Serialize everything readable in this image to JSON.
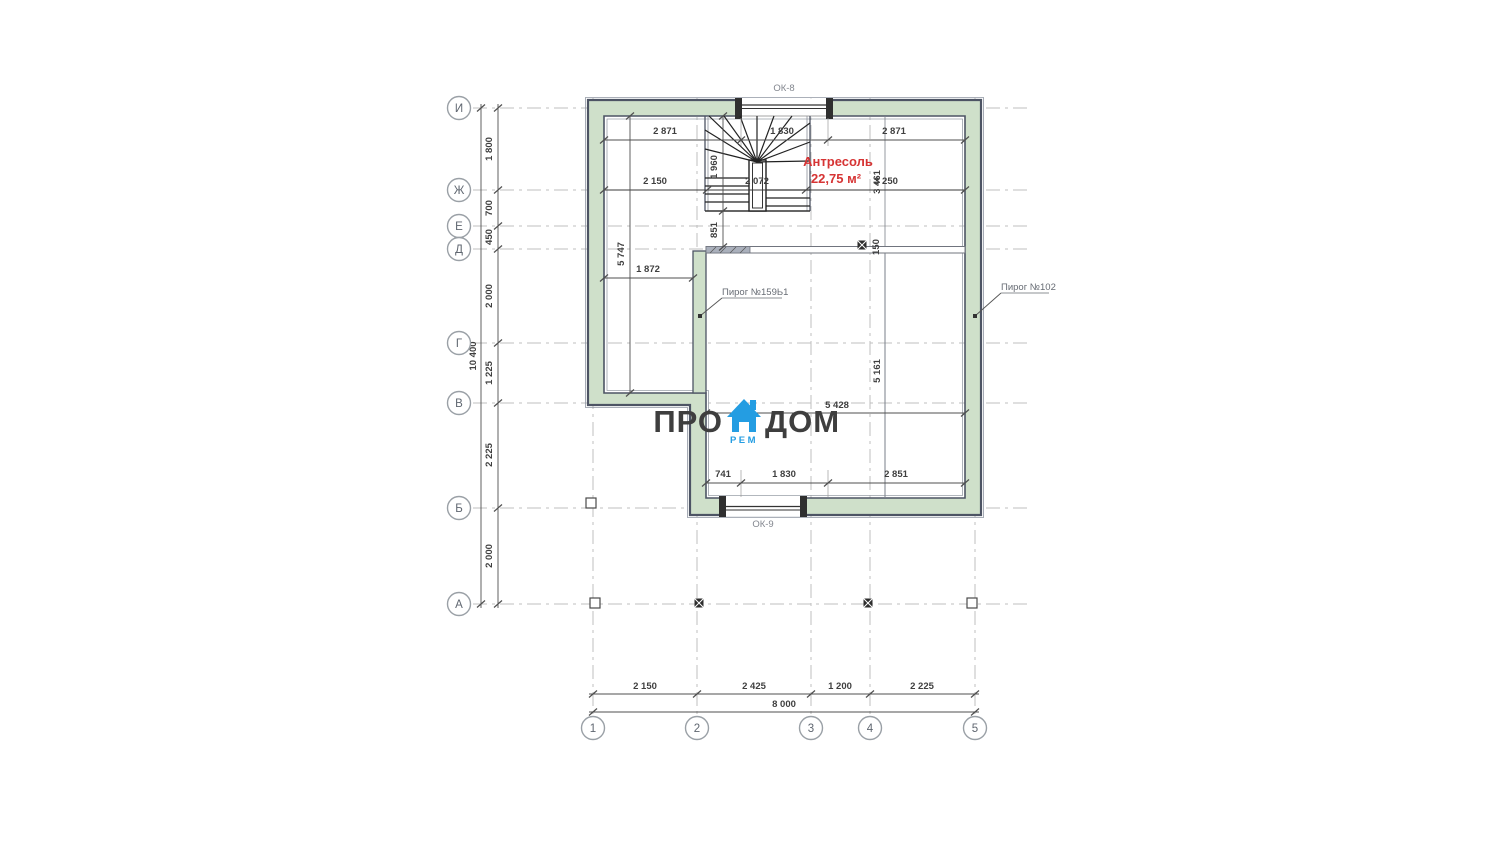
{
  "drawing": {
    "room": {
      "name": "Антресоль",
      "area": "22,75 м²"
    },
    "windows": {
      "top": "ОК-8",
      "bottom": "ОК-9"
    },
    "callouts": {
      "left": "Пирог №159Ь1",
      "right": "Пирог №102"
    },
    "axis_rows": [
      "И",
      "Ж",
      "Е",
      "Д",
      "Г",
      "В",
      "Б",
      "А"
    ],
    "axis_cols": [
      "1",
      "2",
      "3",
      "4",
      "5"
    ],
    "dims": {
      "left_segments": [
        "1 800",
        "700",
        "450",
        "2 000",
        "1 225",
        "2 225",
        "2 000"
      ],
      "left_total": "10 400",
      "bottom_segments": [
        "2 150",
        "2 425",
        "1 200",
        "2 225"
      ],
      "bottom_total": "8 000",
      "top_row": [
        "2 871",
        "1 830",
        "2 871"
      ],
      "zh_row": [
        "2 150",
        "2 072",
        "3 250"
      ],
      "stair_height": "1 960",
      "stair_to_wall": "851",
      "corridor_length": "5 747",
      "corridor_width": "1 872",
      "v_3461": "3 461",
      "wall_thickness": "150",
      "room_height": "5 161",
      "room_width": "5 428",
      "bottom_row": [
        "741",
        "1 830",
        "2 851"
      ]
    }
  },
  "logo": {
    "left": "ПРО",
    "right": "ДОМ",
    "sub": "РЕМ"
  },
  "colors": {
    "wall_fill": "#cfe0ca",
    "wall_edge": "#4d5464",
    "accent_red": "#d63434",
    "logo_blue": "#249de2",
    "logo_text": "#3e3e3e",
    "grid": "#bfbfbf",
    "dim_text": "#3f3f3f"
  }
}
